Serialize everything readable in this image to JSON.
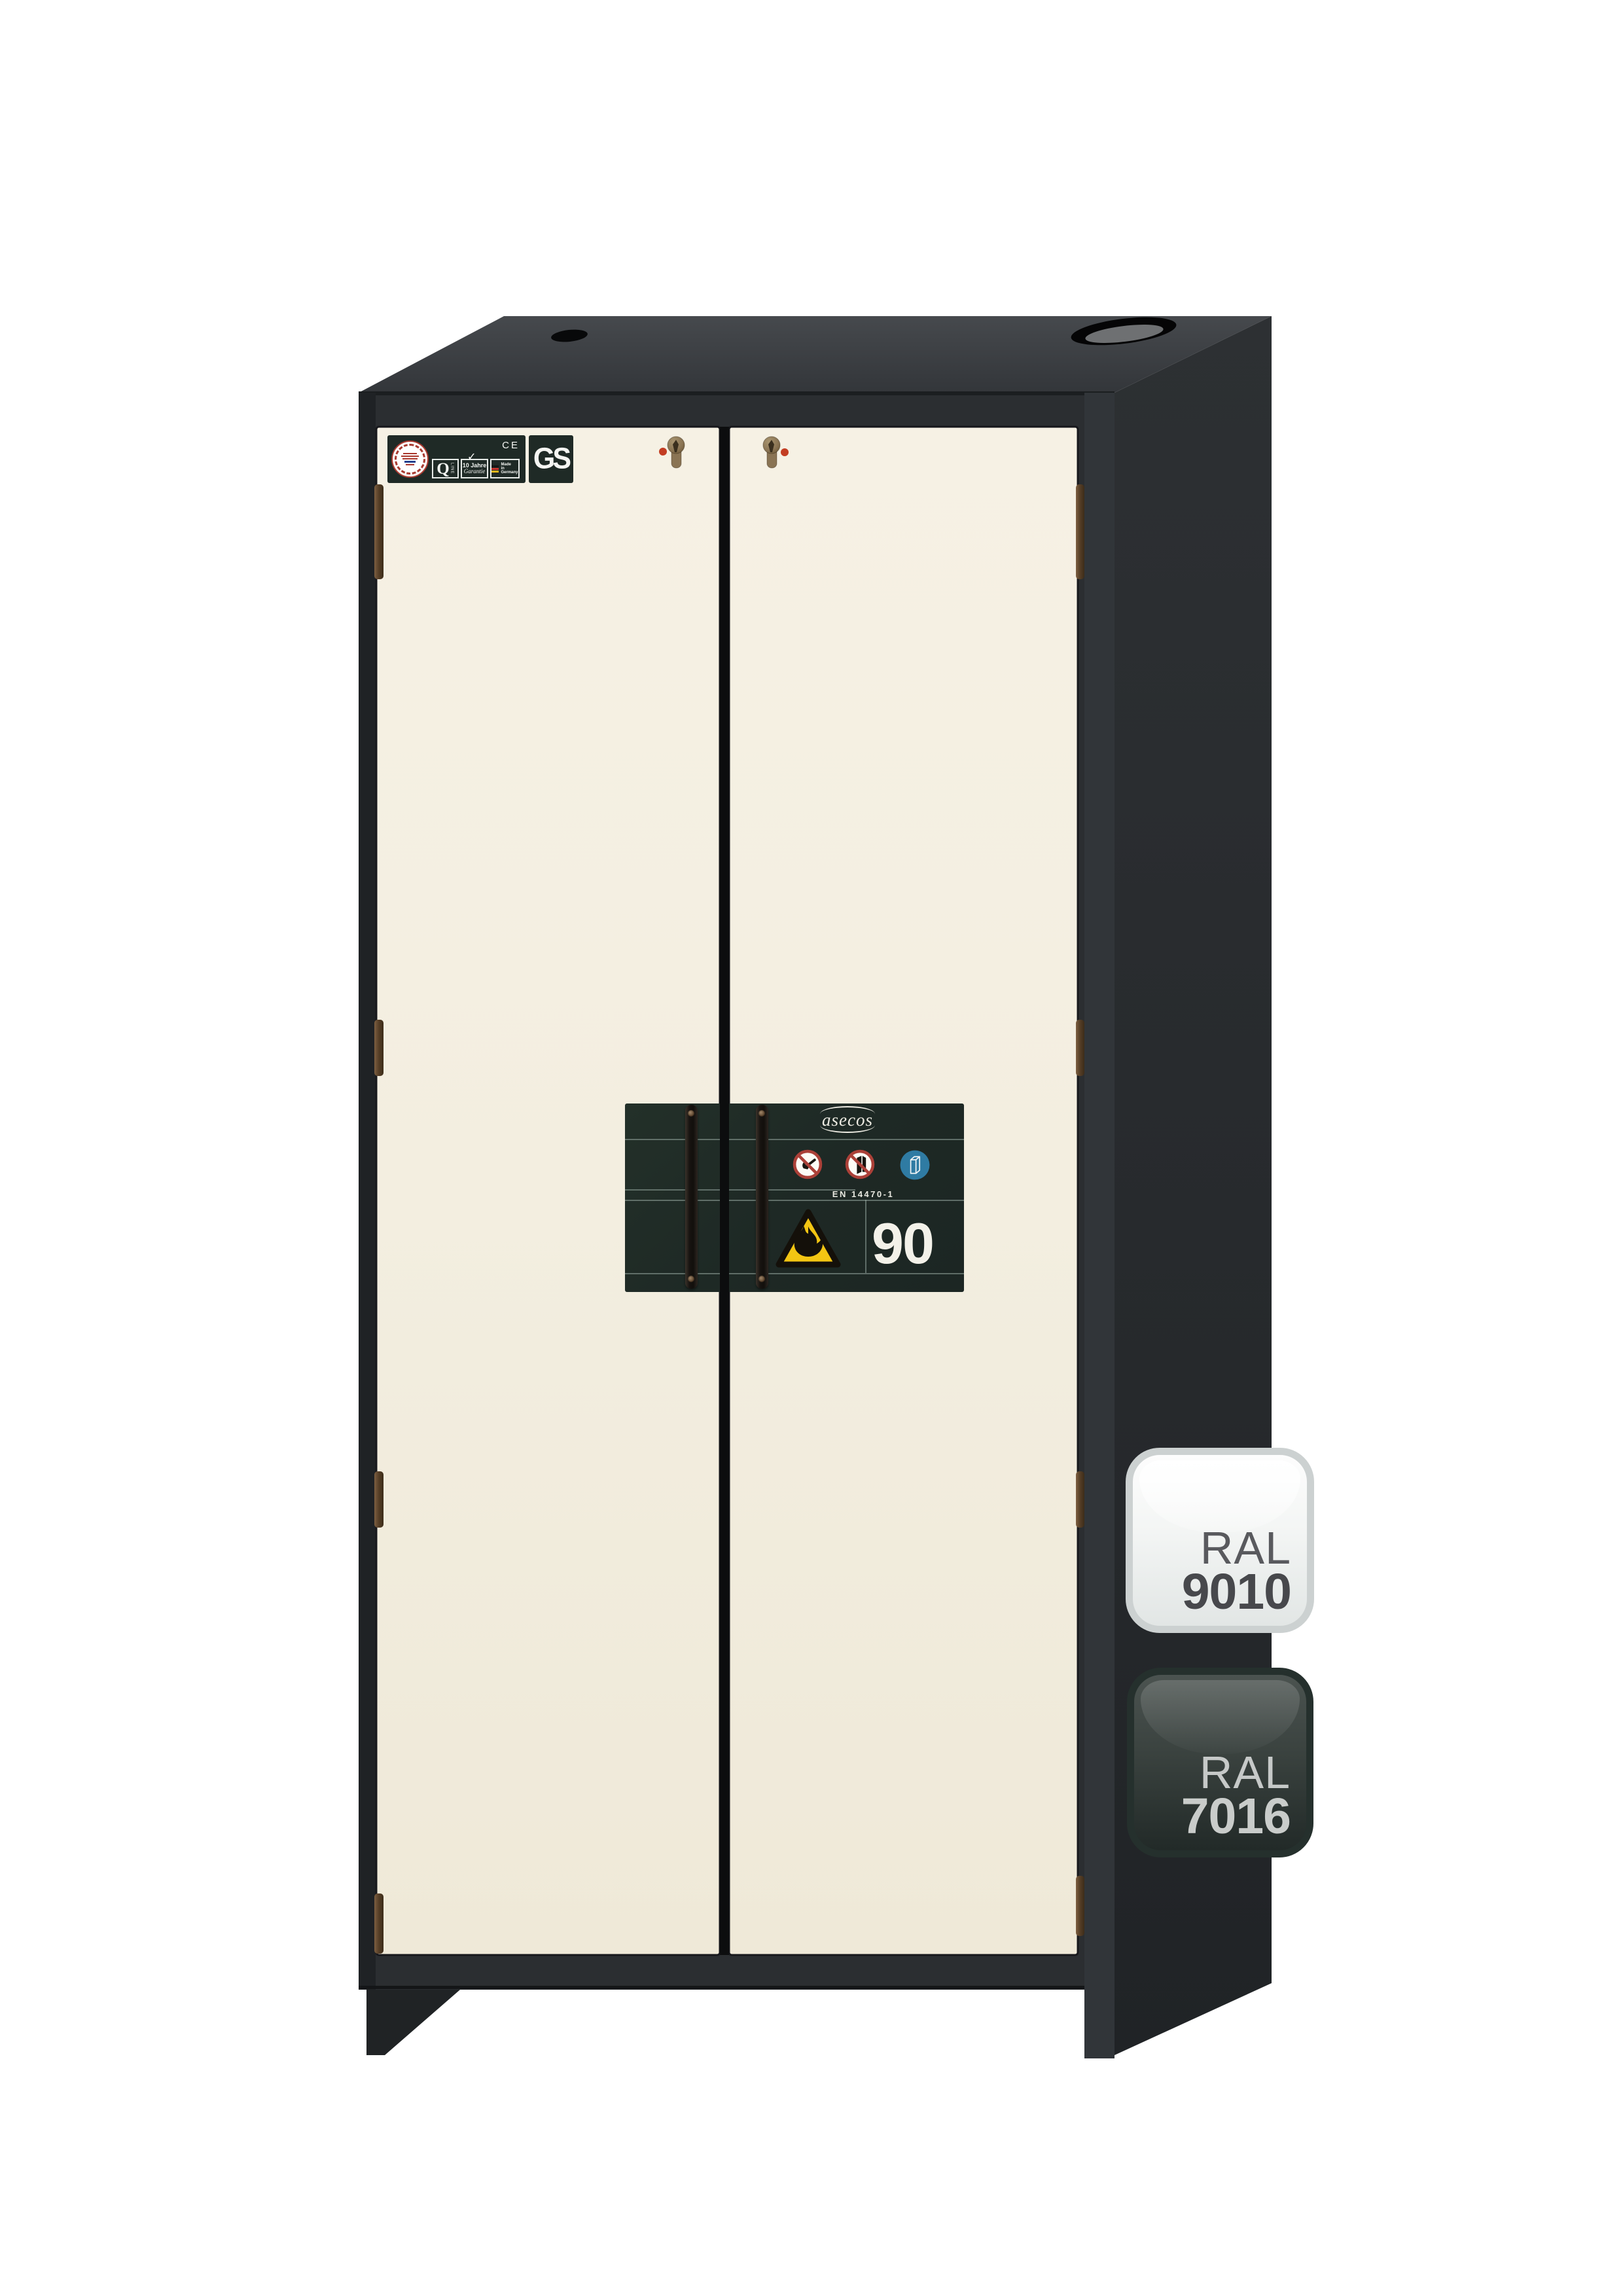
{
  "scene": {
    "background": "#ffffff"
  },
  "cabinet": {
    "colors": {
      "doors": "#f4efe1",
      "carcass_front": "#2b2e31",
      "carcass_side": "#282b2d",
      "carcass_top": "#3b3e41",
      "type_plate": "#202b27",
      "warning_yellow": "#f3c513",
      "mandatory_blue": "#2f7ba3",
      "prohibition_red": "#ab4038",
      "hinge_bronze": "#6d4f35",
      "lock_dot_red": "#c33d22"
    },
    "certification_strip": {
      "ce_mark": "CE",
      "q_line": {
        "letter": "Q",
        "sub": "LINE"
      },
      "warranty": {
        "check": "✓",
        "line1": "10 Jahre",
        "line2": "Garantie"
      },
      "made_in": [
        "Made",
        "in",
        "Germany"
      ],
      "gs_mark": "GS"
    },
    "type_plate": {
      "brand": "asecos",
      "standard": "EN 14470-1",
      "fire_rating": "90"
    },
    "color_badges": [
      {
        "series": "RAL",
        "code": "9010"
      },
      {
        "series": "RAL",
        "code": "7016"
      }
    ]
  }
}
